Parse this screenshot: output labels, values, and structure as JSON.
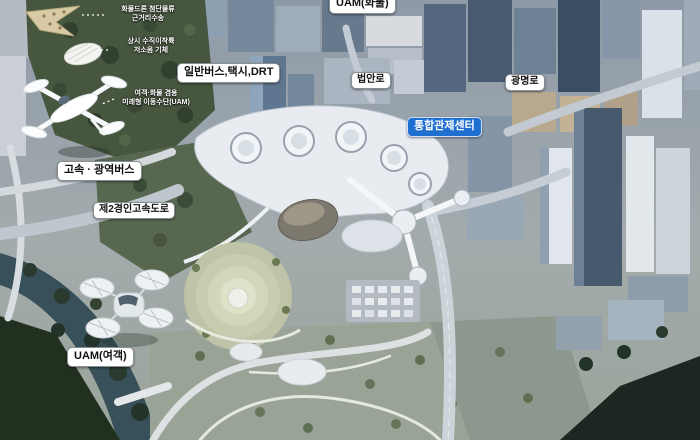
{
  "labels": {
    "uam_cargo": "UAM(화물)",
    "bus_taxi_drt": "일반버스,택시,DRT",
    "beopan_ro": "법안로",
    "gwangmyeong_ro": "광명로",
    "control_center": "통합관제센터",
    "express_bus": "고속 · 광역버스",
    "expressway2": "제2경인고속도로",
    "uam_passenger": "UAM(여객)"
  },
  "annotations": [
    {
      "line1": "화물드론 첨단물류",
      "line2": "근거리수송"
    },
    {
      "line1": "상시 수직이착륙",
      "line2": "저소음 기체"
    },
    {
      "line1": "여객·화물 겸용",
      "line2": "미래형 이동수단(UAM)"
    }
  ],
  "colors": {
    "label_bg": "#ffffff",
    "label_text": "#101010",
    "control_center_bg": "#1f6fd0",
    "control_center_text": "#ffffff",
    "river": "#375059",
    "park_green": "#47563f",
    "hub_white": "#e8ecf0"
  }
}
